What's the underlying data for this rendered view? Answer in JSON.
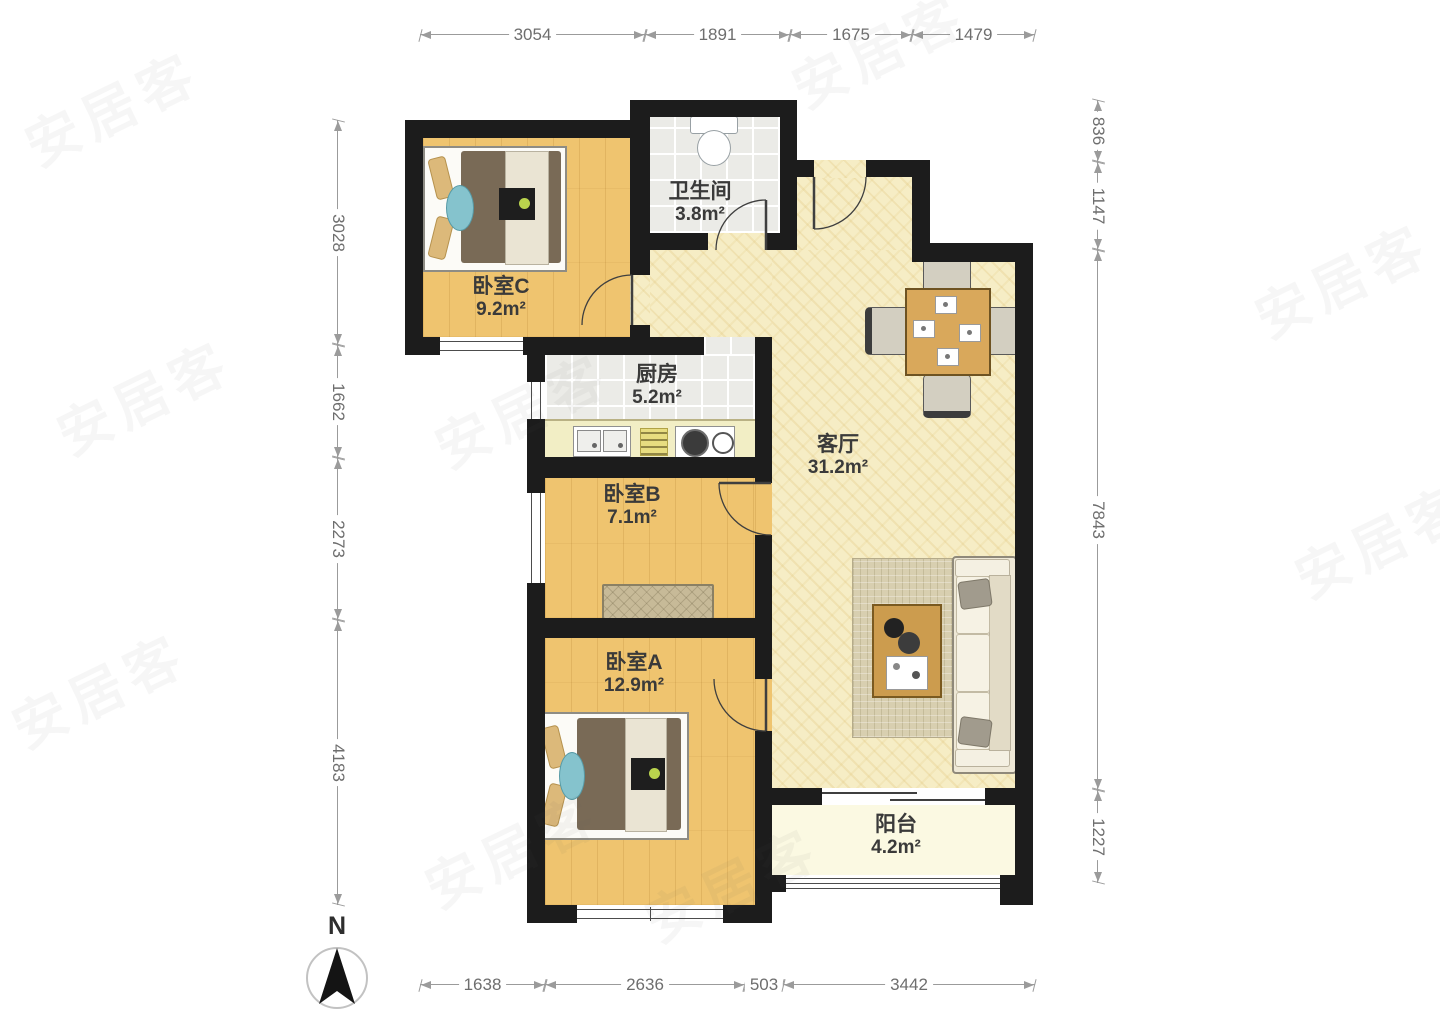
{
  "plan": {
    "compass_label": "N",
    "watermark_text": "安居客",
    "rooms": {
      "bedroom_c": {
        "name": "卧室C",
        "area": "9.2m²"
      },
      "bathroom": {
        "name": "卫生间",
        "area": "3.8m²"
      },
      "kitchen": {
        "name": "厨房",
        "area": "5.2m²"
      },
      "living_room": {
        "name": "客厅",
        "area": "31.2m²"
      },
      "bedroom_b": {
        "name": "卧室B",
        "area": "7.1m²"
      },
      "bedroom_a": {
        "name": "卧室A",
        "area": "12.9m²"
      },
      "balcony": {
        "name": "阳台",
        "area": "4.2m²"
      }
    },
    "dimensions_mm": {
      "top": [
        "3054",
        "1891",
        "1675",
        "1479"
      ],
      "bottom": [
        "1638",
        "2636",
        "503",
        "3442"
      ],
      "left": [
        "3028",
        "1662",
        "2273",
        "4183"
      ],
      "right": [
        "836",
        "1147",
        "7843",
        "1227"
      ]
    },
    "colors": {
      "wall": "#1c1c1c",
      "wood_floor": "#efc46f",
      "living_floor": "#f6edc5",
      "tile_floor": "#ebebe7",
      "balcony_floor": "#fbf9e2",
      "dimension_line": "#9b9b9b",
      "label_text": "#3a3a3a"
    }
  }
}
